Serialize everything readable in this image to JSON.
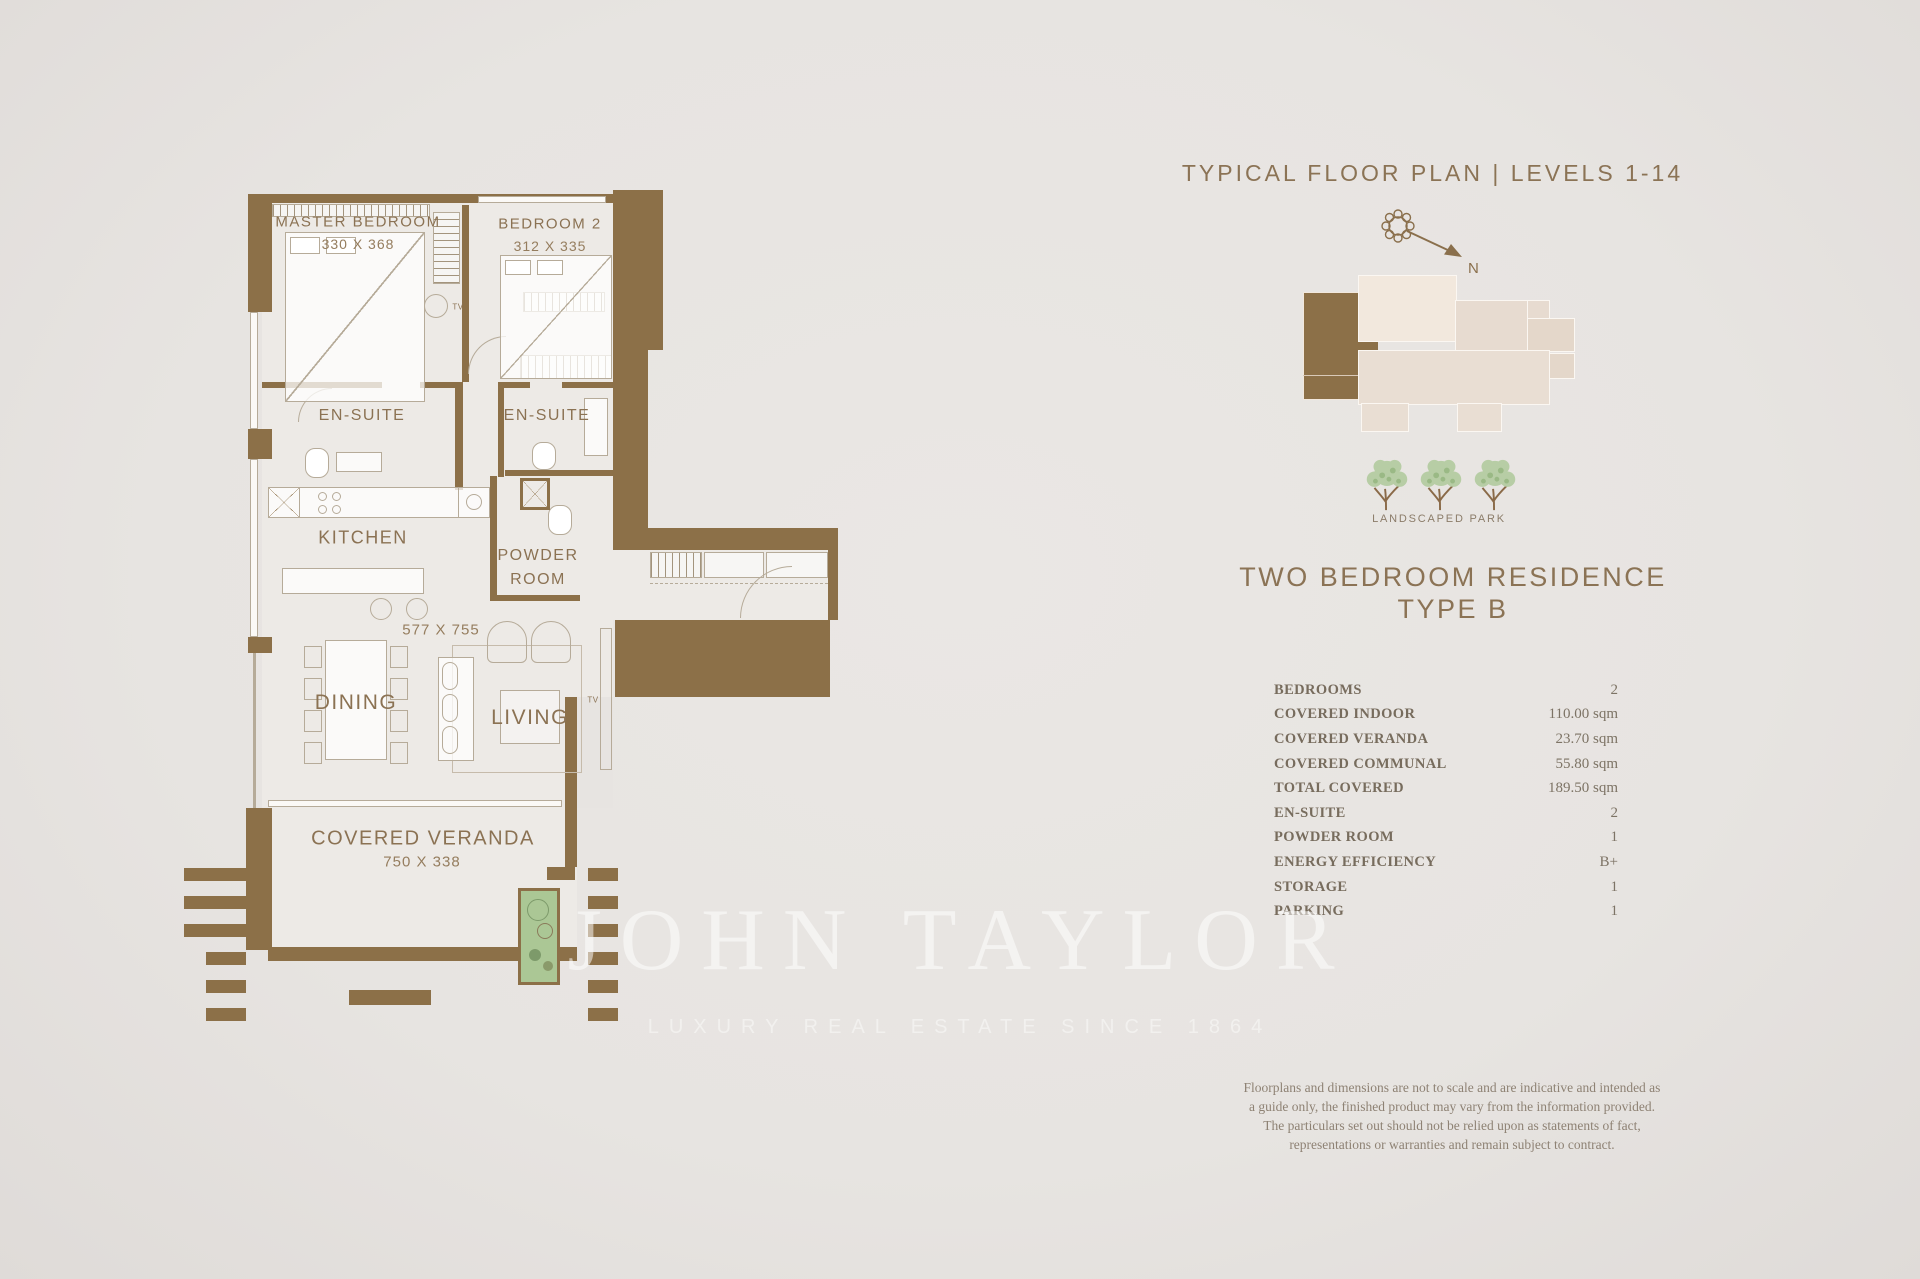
{
  "page": {
    "background": "#e7e4e1",
    "wall_color": "#8c7048",
    "accent_text": "#8b7355"
  },
  "plan": {
    "rooms": {
      "master_bedroom": {
        "label": "MASTER BEDROOM",
        "dims": "330 X 368"
      },
      "bedroom2": {
        "label": "BEDROOM 2",
        "dims": "312 X 335"
      },
      "ensuite1": {
        "label": "EN-SUITE"
      },
      "ensuite2": {
        "label": "EN-SUITE"
      },
      "kitchen": {
        "label": "KITCHEN"
      },
      "powder_room": {
        "line1": "POWDER",
        "line2": "ROOM"
      },
      "living": {
        "label": "LIVING",
        "dims": "577 X 755"
      },
      "dining": {
        "label": "DINING"
      },
      "veranda": {
        "label": "COVERED VERANDA",
        "dims": "750 X 338"
      },
      "tv": "TV"
    }
  },
  "sidebar": {
    "title": "TYPICAL FLOOR PLAN | LEVELS 1-14",
    "compass_label": "N",
    "park_label": "LANDSCAPED PARK",
    "residence_title_line1": "TWO BEDROOM RESIDENCE",
    "residence_title_line2": "TYPE B",
    "specs": [
      {
        "label": "BEDROOMS",
        "value": "2"
      },
      {
        "label": "COVERED INDOOR",
        "value": "110.00 sqm"
      },
      {
        "label": "COVERED VERANDA",
        "value": "23.70 sqm"
      },
      {
        "label": "COVERED COMMUNAL",
        "value": "55.80 sqm"
      },
      {
        "label": "TOTAL COVERED",
        "value": "189.50 sqm"
      },
      {
        "label": "EN-SUITE",
        "value": "2"
      },
      {
        "label": "POWDER ROOM",
        "value": "1"
      },
      {
        "label": "ENERGY EFFICIENCY",
        "value": "B+"
      },
      {
        "label": "STORAGE",
        "value": "1"
      },
      {
        "label": "PARKING",
        "value": "1"
      }
    ],
    "disclaimer": "Floorplans and dimensions are not to scale and are indicative and intended as a guide only, the finished product may vary from the information provided. The particulars set out should not be relied upon as statements of fact, representations or warranties and remain subject to contract."
  },
  "watermark": {
    "line1": "JOHN TAYLOR",
    "line2": "LUXURY REAL ESTATE SINCE 1864"
  }
}
